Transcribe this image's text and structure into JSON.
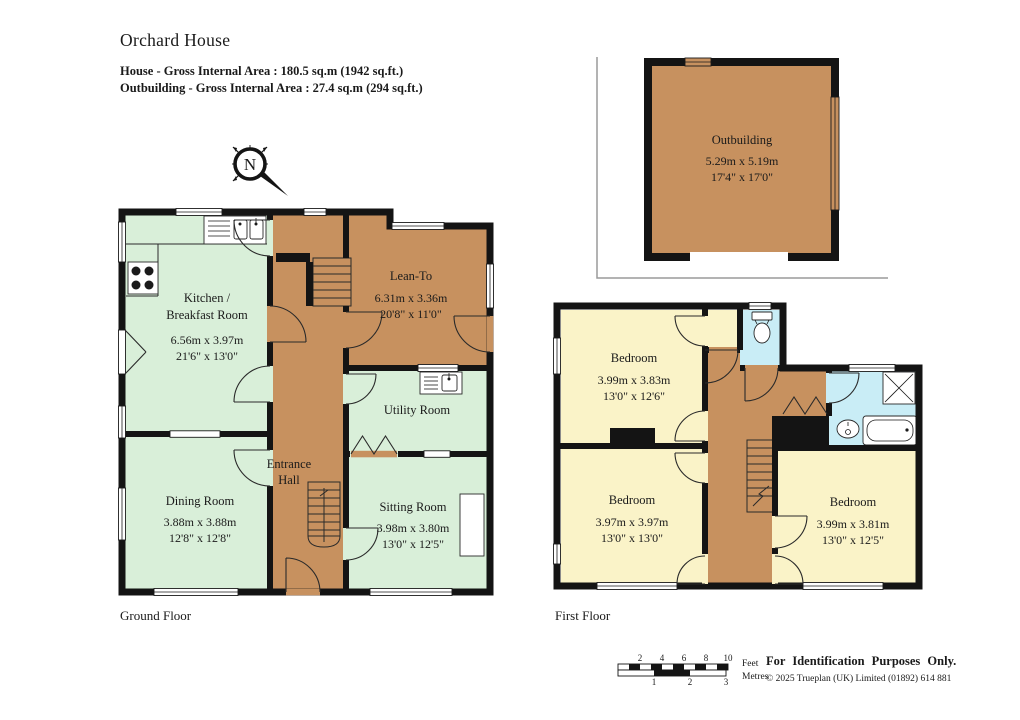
{
  "title": "Orchard House",
  "header": {
    "house_area": "House - Gross Internal Area  :  180.5 sq.m   (1942 sq.ft.)",
    "outbuilding_area": "Outbuilding - Gross Internal Area  :  27.4 sq.m   (294 sq.ft.)"
  },
  "compass": {
    "north_label": "N"
  },
  "outbuilding": {
    "name": "Outbuilding",
    "metric": "5.29m  x  5.19m",
    "imperial": "17'4\"  x  17'0\""
  },
  "ground_floor": {
    "label": "Ground Floor",
    "rooms": {
      "kitchen": {
        "name_line1": "Kitchen /",
        "name_line2": "Breakfast Room",
        "metric": "6.56m  x  3.97m",
        "imperial": "21'6\"  x  13'0\""
      },
      "lean_to": {
        "name": "Lean-To",
        "metric": "6.31m  x  3.36m",
        "imperial": "20'8\"  x  11'0\""
      },
      "utility": {
        "name": "Utility Room"
      },
      "entrance_hall": {
        "name_line1": "Entrance",
        "name_line2": "Hall"
      },
      "dining": {
        "name": "Dining Room",
        "metric": "3.88m  x  3.88m",
        "imperial": "12'8\"  x  12'8\""
      },
      "sitting": {
        "name": "Sitting Room",
        "metric": "3.98m  x  3.80m",
        "imperial": "13'0\"  x  12'5\""
      }
    }
  },
  "first_floor": {
    "label": "First Floor",
    "rooms": {
      "bedroom_front": {
        "name": "Bedroom",
        "metric": "3.99m  x  3.83m",
        "imperial": "13'0\"  x  12'6\""
      },
      "bedroom_left": {
        "name": "Bedroom",
        "metric": "3.97m  x  3.97m",
        "imperial": "13'0\"  x  13'0\""
      },
      "bedroom_right": {
        "name": "Bedroom",
        "metric": "3.99m  x  3.81m",
        "imperial": "13'0\"  x  12'5\""
      }
    }
  },
  "scale_bar": {
    "feet_label": "Feet",
    "metres_label": "Metres",
    "feet_ticks": [
      "2",
      "4",
      "6",
      "8",
      "10"
    ],
    "metre_ticks": [
      "1",
      "2",
      "3"
    ]
  },
  "footer": {
    "line1": "For Identification Purposes Only.",
    "line2": "© 2025 Trueplan (UK) Limited  (01892) 614 881"
  },
  "colors": {
    "room_green": "#d9efd9",
    "room_brown": "#c7915f",
    "room_yellow": "#faf3c8",
    "room_blue": "#c9edf6",
    "wall_black": "#141414",
    "boundary_gray": "#9a9a9a"
  }
}
